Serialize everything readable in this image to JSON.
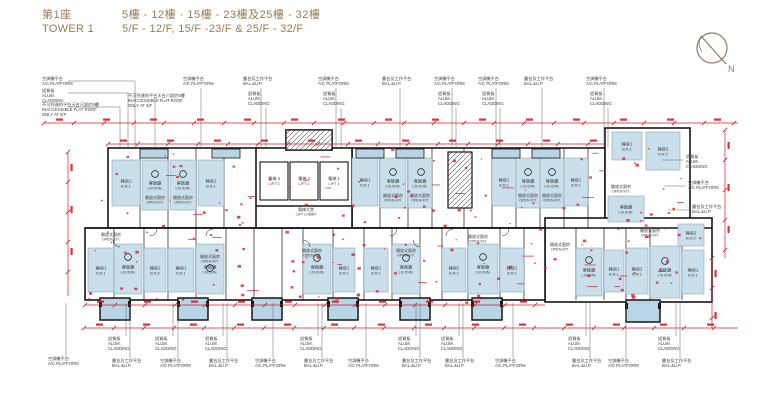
{
  "header": {
    "title_zh": "第1座",
    "title_en": "TOWER 1",
    "floors_zh": "5樓 - 12樓 · 15樓 - 23樓及25樓 - 32樓",
    "floors_en": "5/F - 12/F, 15/F -23/F & 25/F - 32/F"
  },
  "compass": {
    "label": "N"
  },
  "colors": {
    "accent": "#9a7b53",
    "dim_red": "#d0202a",
    "room_blue": "#c9dfeb",
    "balcony_blue": "#b9d4e4",
    "wall_black": "#161616",
    "label_text": "#3c3c3c",
    "compass_brown": "#8c7b63"
  },
  "labels": {
    "ac_platform": {
      "zh": "空調機平台",
      "en": "A/C PLATFORM"
    },
    "bal_up": {
      "zh": "露台及工作平台",
      "en": "BAL.&U.P."
    },
    "alum_cladding": {
      "zh": "鋁質板",
      "en": "ALUM. CLADDING",
      "en_lines": [
        "ALUM.",
        "CLADDING"
      ]
    },
    "inaccessible": {
      "zh": "不可到達的平台天台只設於5樓",
      "en": "INACCESSIBLE FLAT ROOF ONLY AT 5/F",
      "en_lines": [
        "INACCESSIBLE FLAT ROOF",
        "ONLY AT 5/F"
      ]
    }
  },
  "room_names": {
    "liv_din": {
      "zh": "客飯廳",
      "en": "LIV./DIN."
    },
    "br1": {
      "zh": "睡房1",
      "en": "B.R.1"
    },
    "br2": {
      "zh": "睡房2",
      "en": "B.R.2"
    },
    "open_kit": {
      "zh": "開放式廚房",
      "en": "OPEN KIT."
    },
    "lift1": {
      "zh": "電梯 1",
      "en": "LIFT 1"
    },
    "lift2": {
      "zh": "電梯 2",
      "en": "LIFT 2"
    },
    "lift3": {
      "zh": "電梯 3",
      "en": "LIFT 3"
    },
    "lift_lobby": {
      "zh": "電梯大堂",
      "en": "LIFT LOBBY"
    }
  },
  "callouts": {
    "top": [
      {
        "x": 42,
        "y": 80,
        "t": "ac",
        "bx": 135
      },
      {
        "x": 42,
        "y": 92,
        "t": "alum",
        "bx": 128
      },
      {
        "x": 42,
        "y": 106,
        "t": "inacc",
        "bx": 120
      },
      {
        "x": 128,
        "y": 97,
        "t": "inacc",
        "bx": 155
      },
      {
        "x": 183,
        "y": 80,
        "t": "ac"
      },
      {
        "x": 243,
        "y": 80,
        "t": "bal"
      },
      {
        "x": 248,
        "y": 95,
        "t": "alum"
      },
      {
        "x": 318,
        "y": 80,
        "t": "ac"
      },
      {
        "x": 323,
        "y": 95,
        "t": "alum"
      },
      {
        "x": 382,
        "y": 80,
        "t": "bal"
      },
      {
        "x": 434,
        "y": 80,
        "t": "ac"
      },
      {
        "x": 438,
        "y": 95,
        "t": "alum"
      },
      {
        "x": 478,
        "y": 80,
        "t": "ac"
      },
      {
        "x": 482,
        "y": 95,
        "t": "alum"
      },
      {
        "x": 524,
        "y": 80,
        "t": "bal"
      },
      {
        "x": 586,
        "y": 80,
        "t": "ac"
      },
      {
        "x": 590,
        "y": 95,
        "t": "alum"
      }
    ],
    "bottom": [
      {
        "x": 48,
        "y": 360,
        "t": "ac"
      },
      {
        "x": 108,
        "y": 340,
        "t": "alum"
      },
      {
        "x": 112,
        "y": 362,
        "t": "bal"
      },
      {
        "x": 155,
        "y": 340,
        "t": "alum"
      },
      {
        "x": 160,
        "y": 362,
        "t": "ac"
      },
      {
        "x": 205,
        "y": 340,
        "t": "alum"
      },
      {
        "x": 209,
        "y": 362,
        "t": "bal"
      },
      {
        "x": 255,
        "y": 362,
        "t": "ac"
      },
      {
        "x": 300,
        "y": 340,
        "t": "alum"
      },
      {
        "x": 304,
        "y": 362,
        "t": "bal"
      },
      {
        "x": 348,
        "y": 362,
        "t": "ac"
      },
      {
        "x": 398,
        "y": 340,
        "t": "alum"
      },
      {
        "x": 402,
        "y": 362,
        "t": "bal"
      },
      {
        "x": 441,
        "y": 340,
        "t": "alum"
      },
      {
        "x": 445,
        "y": 362,
        "t": "bal"
      },
      {
        "x": 495,
        "y": 362,
        "t": "ac"
      },
      {
        "x": 568,
        "y": 340,
        "t": "alum"
      },
      {
        "x": 572,
        "y": 362,
        "t": "bal"
      },
      {
        "x": 608,
        "y": 362,
        "t": "ac"
      },
      {
        "x": 658,
        "y": 340,
        "t": "alum"
      },
      {
        "x": 662,
        "y": 362,
        "t": "bal"
      }
    ],
    "right": [
      {
        "x": 686,
        "y": 158,
        "t": "alum"
      },
      {
        "x": 688,
        "y": 184,
        "t": "ac"
      },
      {
        "x": 692,
        "y": 208,
        "t": "bal"
      }
    ]
  },
  "plan": {
    "footprint": [
      [
        108,
        148,
        150,
        80
      ],
      [
        352,
        148,
        253,
        80
      ],
      [
        605,
        128,
        85,
        97
      ],
      [
        545,
        218,
        167,
        84
      ],
      [
        85,
        228,
        460,
        72
      ],
      [
        256,
        148,
        96,
        80
      ],
      [
        286,
        130,
        46,
        20
      ]
    ],
    "stairs": [
      [
        286,
        130,
        46,
        20
      ],
      [
        448,
        152,
        24,
        56
      ]
    ],
    "lifts": [
      {
        "x": 260,
        "y": 162,
        "w": 28,
        "h": 38,
        "k": "lift3"
      },
      {
        "x": 290,
        "y": 162,
        "w": 28,
        "h": 38,
        "k": "lift2"
      },
      {
        "x": 320,
        "y": 162,
        "w": 28,
        "h": 38,
        "k": "lift1"
      }
    ],
    "strips": [
      [
        140,
        149,
        28,
        9
      ],
      [
        212,
        149,
        28,
        9
      ],
      [
        356,
        149,
        28,
        9
      ],
      [
        396,
        149,
        28,
        9
      ],
      [
        492,
        149,
        28,
        9
      ],
      [
        532,
        149,
        28,
        9
      ]
    ],
    "balconies": [
      [
        100,
        298,
        30,
        22
      ],
      [
        178,
        298,
        30,
        22
      ],
      [
        252,
        298,
        30,
        22
      ],
      [
        328,
        298,
        30,
        22
      ],
      [
        400,
        298,
        30,
        22
      ],
      [
        472,
        298,
        30,
        22
      ],
      [
        626,
        300,
        34,
        22
      ]
    ],
    "rooms": [
      {
        "x": 112,
        "y": 160,
        "w": 28,
        "h": 46,
        "k": "br1"
      },
      {
        "x": 142,
        "y": 160,
        "w": 26,
        "h": 50,
        "k": "liv_din"
      },
      {
        "x": 170,
        "y": 160,
        "w": 26,
        "h": 50,
        "k": "liv_din"
      },
      {
        "x": 198,
        "y": 160,
        "w": 26,
        "h": 46,
        "k": "br1"
      },
      {
        "x": 352,
        "y": 158,
        "w": 26,
        "h": 48,
        "k": "br1"
      },
      {
        "x": 380,
        "y": 158,
        "w": 26,
        "h": 50,
        "k": "liv_din"
      },
      {
        "x": 408,
        "y": 158,
        "w": 24,
        "h": 50,
        "k": "liv_din"
      },
      {
        "x": 492,
        "y": 158,
        "w": 24,
        "h": 48,
        "k": "br1"
      },
      {
        "x": 516,
        "y": 158,
        "w": 24,
        "h": 50,
        "k": "liv_din"
      },
      {
        "x": 540,
        "y": 158,
        "w": 24,
        "h": 50,
        "k": "liv_din"
      },
      {
        "x": 564,
        "y": 158,
        "w": 24,
        "h": 48,
        "k": "br1"
      },
      {
        "x": 612,
        "y": 132,
        "w": 30,
        "h": 28,
        "k": "br1"
      },
      {
        "x": 646,
        "y": 132,
        "w": 34,
        "h": 38,
        "k": "br2"
      },
      {
        "x": 608,
        "y": 196,
        "w": 36,
        "h": 26,
        "k": "liv_din"
      },
      {
        "x": 88,
        "y": 248,
        "w": 26,
        "h": 44,
        "k": "br1"
      },
      {
        "x": 114,
        "y": 244,
        "w": 28,
        "h": 50,
        "k": "liv_din"
      },
      {
        "x": 144,
        "y": 248,
        "w": 22,
        "h": 44,
        "k": "br2"
      },
      {
        "x": 168,
        "y": 248,
        "w": 26,
        "h": 44,
        "k": "br1"
      },
      {
        "x": 196,
        "y": 244,
        "w": 28,
        "h": 50,
        "k": "liv_din"
      },
      {
        "x": 303,
        "y": 244,
        "w": 28,
        "h": 50,
        "k": "liv_din"
      },
      {
        "x": 333,
        "y": 248,
        "w": 22,
        "h": 44,
        "k": "br1"
      },
      {
        "x": 364,
        "y": 248,
        "w": 24,
        "h": 44,
        "k": "br1"
      },
      {
        "x": 392,
        "y": 244,
        "w": 28,
        "h": 50,
        "k": "liv_din"
      },
      {
        "x": 442,
        "y": 248,
        "w": 24,
        "h": 44,
        "k": "br2"
      },
      {
        "x": 468,
        "y": 244,
        "w": 30,
        "h": 50,
        "k": "liv_din"
      },
      {
        "x": 500,
        "y": 248,
        "w": 24,
        "h": 44,
        "k": "br1"
      },
      {
        "x": 576,
        "y": 248,
        "w": 26,
        "h": 48,
        "k": "liv_din"
      },
      {
        "x": 604,
        "y": 250,
        "w": 20,
        "h": 42,
        "k": "br1"
      },
      {
        "x": 626,
        "y": 248,
        "w": 22,
        "h": 46,
        "k": "br2"
      },
      {
        "x": 650,
        "y": 246,
        "w": 30,
        "h": 52,
        "k": "liv_din"
      },
      {
        "x": 682,
        "y": 250,
        "w": 22,
        "h": 44,
        "k": "br1"
      },
      {
        "x": 678,
        "y": 224,
        "w": 26,
        "h": 22,
        "k": "br2"
      }
    ],
    "extra_labels": [
      {
        "x": 155,
        "y": 199,
        "k": "open_kit"
      },
      {
        "x": 183,
        "y": 199,
        "k": "open_kit"
      },
      {
        "x": 393,
        "y": 197,
        "k": "open_kit"
      },
      {
        "x": 420,
        "y": 197,
        "k": "open_kit"
      },
      {
        "x": 528,
        "y": 197,
        "k": "open_kit"
      },
      {
        "x": 552,
        "y": 197,
        "k": "open_kit"
      },
      {
        "x": 621,
        "y": 188,
        "k": "open_kit"
      },
      {
        "x": 111,
        "y": 236,
        "k": "open_kit"
      },
      {
        "x": 210,
        "y": 258,
        "k": "open_kit"
      },
      {
        "x": 312,
        "y": 252,
        "k": "open_kit"
      },
      {
        "x": 406,
        "y": 252,
        "k": "open_kit"
      },
      {
        "x": 478,
        "y": 238,
        "k": "open_kit"
      },
      {
        "x": 560,
        "y": 246,
        "k": "open_kit"
      },
      {
        "x": 650,
        "y": 232,
        "k": "open_kit"
      },
      {
        "x": 306,
        "y": 211,
        "k": "lift_lobby"
      }
    ],
    "circles": [
      [
        155,
        174
      ],
      [
        183,
        174
      ],
      [
        393,
        172
      ],
      [
        421,
        172
      ],
      [
        528,
        172
      ],
      [
        552,
        172
      ],
      [
        128,
        257
      ],
      [
        210,
        268
      ],
      [
        317,
        258
      ],
      [
        406,
        258
      ],
      [
        483,
        257
      ],
      [
        589,
        260
      ],
      [
        665,
        261
      ]
    ],
    "walls_v": {
      "top": [
        140,
        168,
        196,
        224,
        380,
        408,
        432,
        464,
        492,
        516,
        540,
        564,
        588
      ],
      "bottom": [
        114,
        144,
        168,
        196,
        226,
        254,
        282,
        303,
        333,
        364,
        392,
        420,
        442,
        468,
        500,
        524,
        545,
        576,
        604,
        626,
        650,
        682
      ]
    },
    "black_lines": [
      [
        85,
        228,
        712,
        228
      ],
      [
        256,
        206,
        352,
        206
      ]
    ],
    "dims": {
      "h": [
        {
          "y": 123,
          "x1": 44,
          "x2": 738
        },
        {
          "y": 144,
          "x1": 108,
          "x2": 605
        },
        {
          "y": 305,
          "x1": 85,
          "x2": 545
        },
        {
          "y": 328,
          "x1": 84,
          "x2": 738
        }
      ],
      "v": [
        {
          "x": 68,
          "y1": 152,
          "y2": 296
        },
        {
          "x": 725,
          "y1": 130,
          "y2": 258
        },
        {
          "x": 712,
          "y1": 258,
          "y2": 328
        }
      ]
    }
  }
}
